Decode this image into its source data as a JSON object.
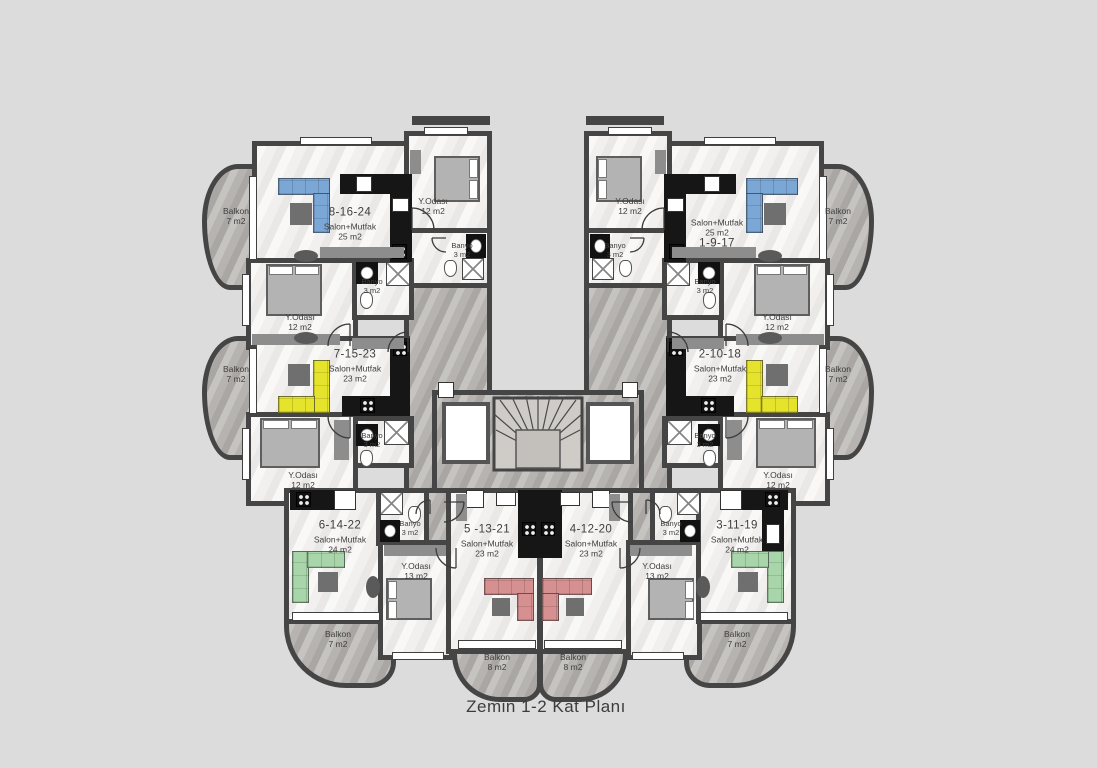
{
  "title": "Zemin 1-2 Kat Planı",
  "colors": {
    "background": "#dcdcdc",
    "walls": "#454545",
    "floor": "#f1f0ee",
    "terrace_marble": "#b6b3b0",
    "sofa_blue": "#7ba7d7",
    "sofa_yellow": "#e6e32c",
    "sofa_green": "#a8d6aa",
    "sofa_red": "#d79090"
  },
  "units": {
    "u8": {
      "no": "8-16-24",
      "room": "Salon+Mutfak",
      "area": "25 m2"
    },
    "u1": {
      "no": "1-9-17",
      "room": "Salon+Mutfak",
      "area": "25 m2"
    },
    "u7": {
      "no": "7-15-23",
      "room": "Salon+Mutfak",
      "area": "23 m2"
    },
    "u2": {
      "no": "2-10-18",
      "room": "Salon+Mutfak",
      "area": "23 m2"
    },
    "u6": {
      "no": "6-14-22",
      "room": "Salon+Mutfak",
      "area": "24 m2"
    },
    "u5": {
      "no": "5 -13-21",
      "room": "Salon+Mutfak",
      "area": "23 m2"
    },
    "u4": {
      "no": "4-12-20",
      "room": "Salon+Mutfak",
      "area": "23 m2"
    },
    "u3": {
      "no": "3-11-19",
      "room": "Salon+Mutfak",
      "area": "24 m2"
    }
  },
  "rooms": {
    "bedroom12": {
      "name": "Y.Odası",
      "area": "12 m2"
    },
    "bedroom13": {
      "name": "Y.Odası",
      "area": "13 m2"
    },
    "banyo": {
      "name": "Banyo",
      "area": "3 m2"
    },
    "balkon7": {
      "name": "Balkon",
      "area": "7 m2"
    },
    "balkon8": {
      "name": "Balkon",
      "area": "8 m2"
    }
  }
}
